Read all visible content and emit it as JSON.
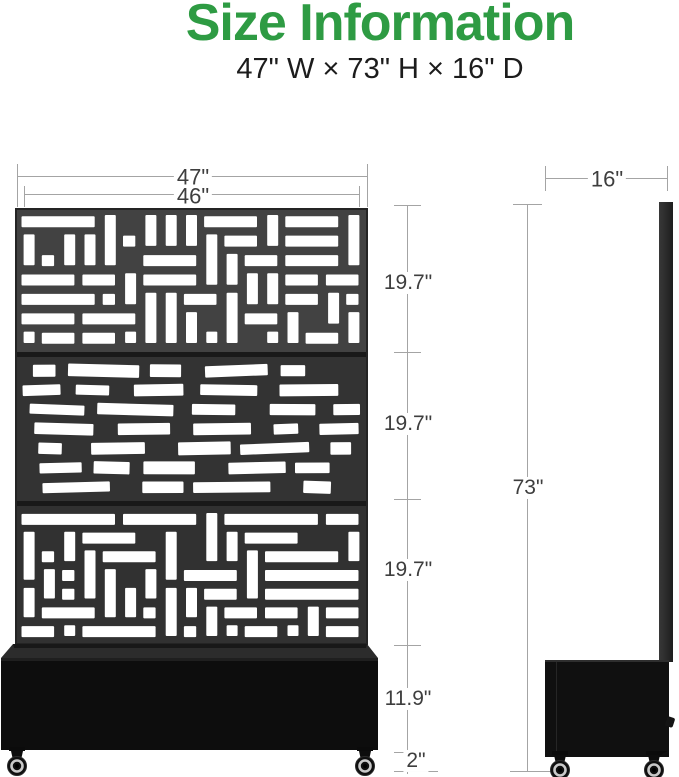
{
  "header": {
    "title": "Size Information",
    "subtitle": "47\" W × 73\" H × 16\" D"
  },
  "dims": {
    "width_outer": "47\"",
    "width_inner": "46\"",
    "panel_section_1": "19.7\"",
    "panel_section_2": "19.7\"",
    "panel_section_3": "19.7\"",
    "planter_height": "11.9\"",
    "caster_height": "2\"",
    "total_height": "73\"",
    "depth": "16\""
  },
  "colors": {
    "accent_green": "#2e9b43",
    "subtitle_text": "#1c1c1c",
    "dim_line": "#a4a4a4",
    "dim_text": "#3e3e3e",
    "cutout_white": "#ffffff",
    "panel_divider": "#191919",
    "planter_black": "#0d0d0d",
    "planter_rim": "#2c2c2c"
  },
  "front_panel": {
    "sections": [
      {
        "type": "weave",
        "bg": "#424242"
      },
      {
        "type": "scatter",
        "bg": "#333333"
      },
      {
        "type": "weave",
        "bg": "#313131"
      }
    ]
  }
}
